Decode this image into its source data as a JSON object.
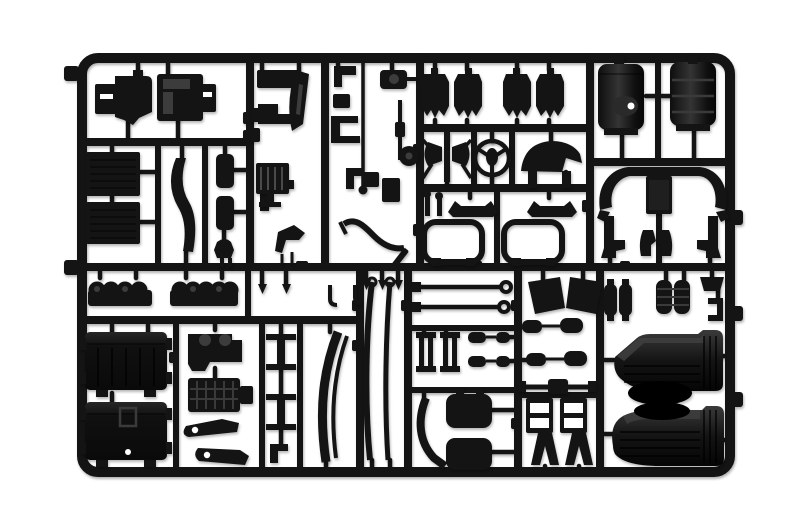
{
  "scene": {
    "kind": "product photograph",
    "subject": "black injection-molded plastic model-kit sprue (parts tree) with truck model parts on a white background",
    "background_color": "#ffffff",
    "plastic_color": "#141414",
    "plastic_highlight": "#3c3c3c",
    "detail_white": "#ffffff"
  },
  "sprue": {
    "frame_shape": "rounded rectangle with internal runner grid",
    "parts_inventory": [
      "cab panel small",
      "cab panel large",
      "radiator cores",
      "curved stay arm",
      "side hatch panels",
      "front grille",
      "mirror arm and brackets",
      "pipe and antenna cluster",
      "seat backs",
      "seat mounts",
      "steering wheel",
      "dashboard cowl",
      "sun visor benches",
      "cab floor frames",
      "fuel tank with filler",
      "ribbed fuel tank",
      "bumper cross member",
      "step brackets",
      "cylinder bank halves",
      "storage boxes",
      "engine block",
      "gearbox",
      "suspension levers",
      "chassis cross members",
      "leaf springs",
      "tie rods",
      "axle stanchions",
      "shock absorbers",
      "mud flaps",
      "rear axle",
      "ladder brackets",
      "air tanks",
      "rear mudguards"
    ]
  }
}
